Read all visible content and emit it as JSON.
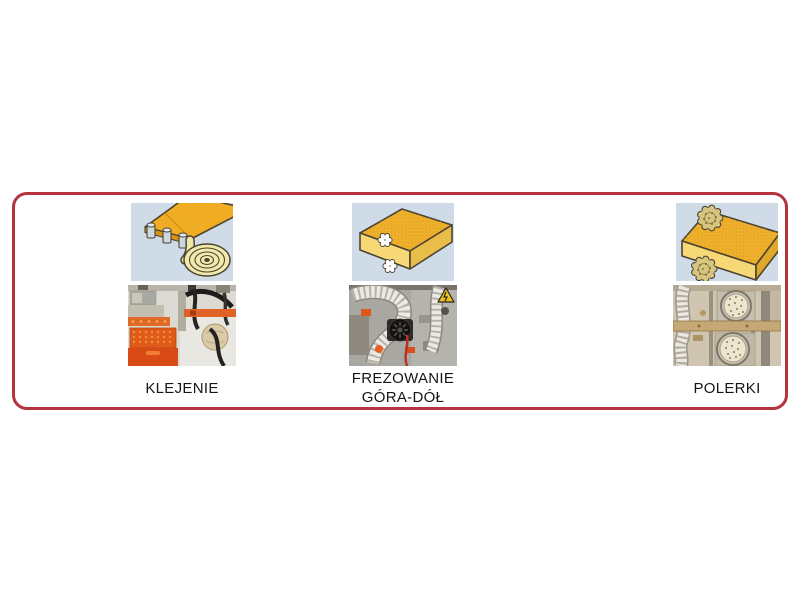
{
  "frame": {
    "border_color": "#b5333f"
  },
  "processes": [
    {
      "id": "klejenie",
      "label_lines": [
        "KLEJENIE"
      ],
      "illustration": "panel-edge-gluing-with-banding-coil",
      "photo": "edge-banding-gluing-unit"
    },
    {
      "id": "frezowanie-gora-dol",
      "label_lines": [
        "FREZOWANIE",
        "GÓRA-DÓŁ"
      ],
      "illustration": "panel-top-and-bottom-milling-cutters",
      "photo": "top-bottom-milling-unit-with-hoses"
    },
    {
      "id": "polerki",
      "label_lines": [
        "POLERKI"
      ],
      "illustration": "panel-edge-polishing-discs",
      "photo": "polishing-discs-unit"
    }
  ],
  "colors": {
    "frame_border": "#b5333f",
    "illustration_background": "#cfdce7",
    "board_yellow": "#eeb02c",
    "board_front_yellow": "#f7d877",
    "page_background": "#ffffff",
    "machine_orange": "#e05a1a",
    "warning_yellow": "#f0c11c"
  }
}
